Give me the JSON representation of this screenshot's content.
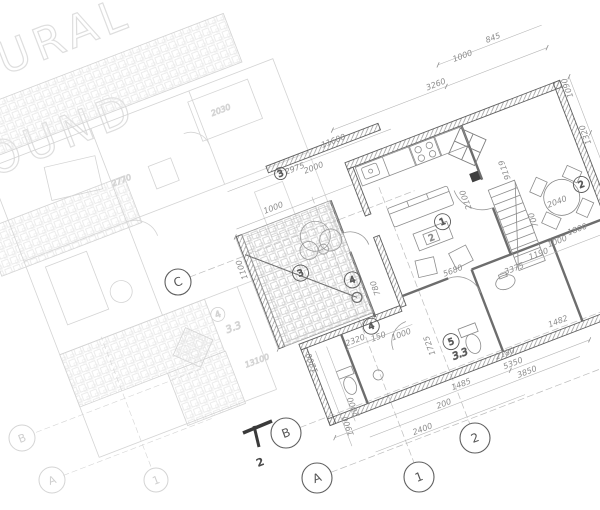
{
  "watermark": {
    "line1": "ARCHITECTURAL",
    "line2": "BACKGROUND"
  },
  "grid_bubbles": {
    "main": [
      "C",
      "B",
      "A",
      "1",
      "2"
    ],
    "faint": [
      "B",
      "A",
      "1"
    ]
  },
  "section_mark": {
    "label": "2"
  },
  "room_tags": {
    "living": "1",
    "dining": "2",
    "terrace": "3",
    "hall": "4",
    "bath": "4",
    "store": "5",
    "faint_hall": "4",
    "window": "3",
    "table_plate": "2"
  },
  "levels": {
    "store_level": "3.3",
    "faint_level": "3.3"
  },
  "dims": [
    "2975",
    "11600",
    "2000",
    "3260",
    "1000",
    "845",
    "1090",
    "1320",
    "1620",
    "1000",
    "1100",
    "5680",
    "2100",
    "700",
    "9119",
    "2040",
    "780",
    "2320",
    "150",
    "1000",
    "1725",
    "3375",
    "1190",
    "1000",
    "1800",
    "1200",
    "1900",
    "2000",
    "2400",
    "200",
    "1485",
    "2180",
    "5350",
    "3850",
    "1482"
  ],
  "faint_dims": [
    "2030",
    "2770",
    "13100"
  ],
  "colors": {
    "paper": "#ffffff",
    "wall_line": "#606060",
    "dark_line": "#3a3a3a",
    "dim_text": "#8c8c8c",
    "faint_line": "#d8d8d8",
    "watermark": "#dedede"
  }
}
